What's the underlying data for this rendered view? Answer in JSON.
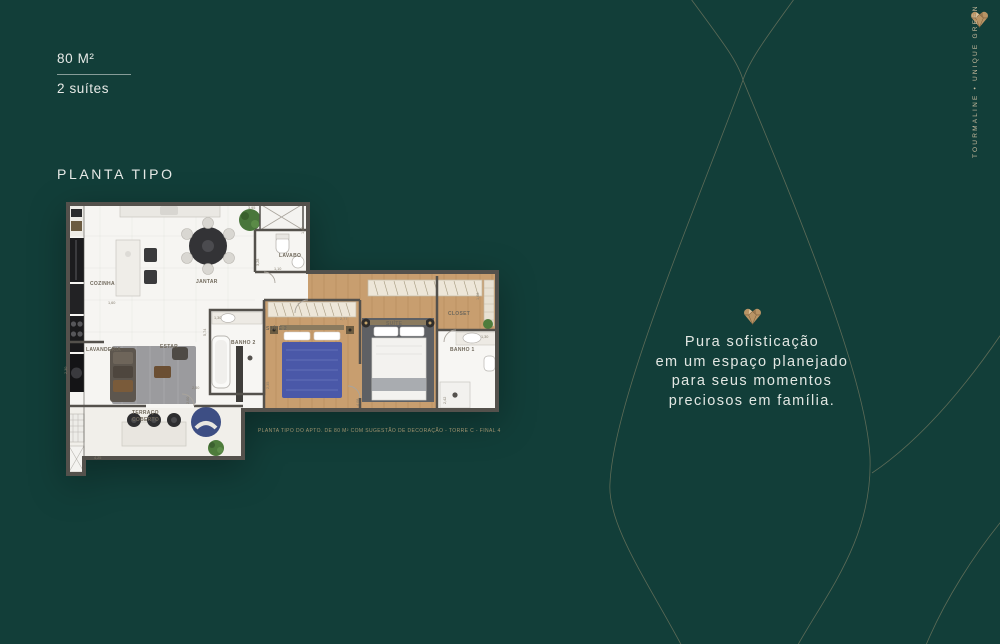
{
  "brand": {
    "vertical_label": "TOURMALINE • UNIQUE GREEN"
  },
  "unit_info": {
    "area": "80 M²",
    "suites": "2 suítes"
  },
  "section_title": "PLANTA TIPO",
  "floor_plan": {
    "caption": "PLANTA TIPO DO APTO. DE 80 M² COM SUGESTÃO DE DECORAÇÃO - TORRE C - FINAL 4",
    "rooms": [
      {
        "label": "COZINHA"
      },
      {
        "label": "JANTAR"
      },
      {
        "label": "LAVABO"
      },
      {
        "label": "LAVANDERIA"
      },
      {
        "label": "ESTAR"
      },
      {
        "label": "BANHO 2"
      },
      {
        "label": "SUÍTE 2"
      },
      {
        "label": "SUÍTE"
      },
      {
        "label": "CLOSET"
      },
      {
        "label": "BANHO 1"
      },
      {
        "label": "TERRAÇO"
      },
      {
        "label": "COBERTO"
      }
    ],
    "dimensions": [
      "3,95",
      "1,42",
      "3,28",
      "1,10",
      "1,60",
      "1,30",
      "5,74",
      "2,77",
      "1,66",
      "1,30",
      "2,42",
      "4,08",
      "2,35",
      "2,50",
      "2,00",
      "2,30",
      "4,25"
    ]
  },
  "tagline": {
    "line1": "Pura sofisticação",
    "line2": "em um espaço planejado",
    "line3": "para seus momentos",
    "line4": "preciosos em família."
  },
  "colors": {
    "background": "#123E39",
    "accent_gold": "#BFA06E",
    "text_light": "#E7EAE7",
    "brand_text": "#C8BB9E"
  }
}
